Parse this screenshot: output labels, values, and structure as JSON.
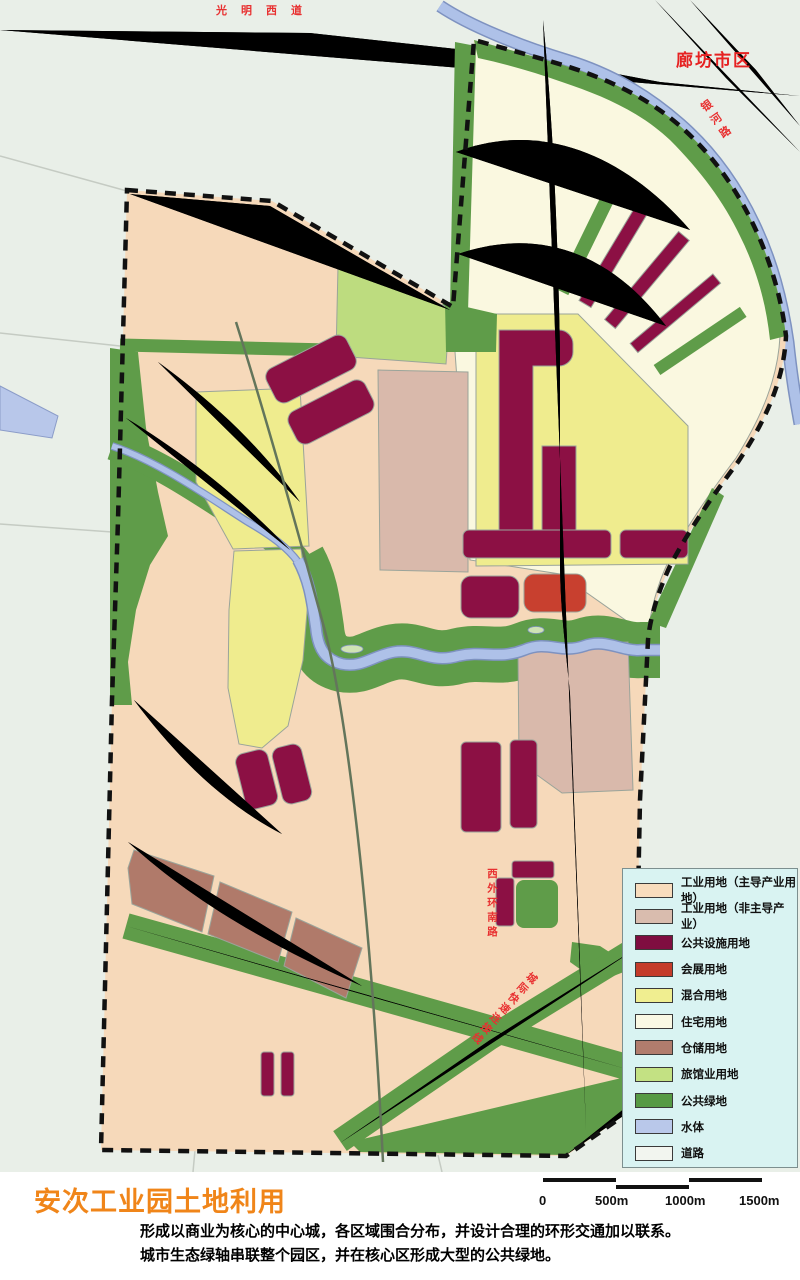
{
  "map": {
    "labels": {
      "road_top": "光明西道",
      "city": "廊坊市区",
      "road_ne": "银河路",
      "road_west_ring": "西外环南路",
      "road_intercity": "城际快速连接线"
    },
    "colors": {
      "background": "#e9efe8",
      "boundary": "#111111",
      "road_label_red": "#e83030",
      "city_label_red": "#e62222",
      "title_orange": "#f08519"
    }
  },
  "legend": {
    "items": [
      {
        "label": "工业用地（主导产业用地）",
        "color": "#f8dcbd"
      },
      {
        "label": "工业用地（非主导产业）",
        "color": "#d9bcae"
      },
      {
        "label": "公共设施用地",
        "color": "#7f0d40"
      },
      {
        "label": "会展用地",
        "color": "#c43b2a"
      },
      {
        "label": "混合用地",
        "color": "#f0ee90"
      },
      {
        "label": "住宅用地",
        "color": "#faf8e4"
      },
      {
        "label": "仓储用地",
        "color": "#b17c6d"
      },
      {
        "label": "旅馆业用地",
        "color": "#c3e183"
      },
      {
        "label": "公共绿地",
        "color": "#569a44"
      },
      {
        "label": "水体",
        "color": "#b9c8ea"
      },
      {
        "label": "道路",
        "color": "#f2f5ef"
      }
    ]
  },
  "footer": {
    "title": "安次工业园土地利用",
    "scale_labels": [
      "0",
      "500m",
      "1000m",
      "1500m"
    ],
    "description_lines": [
      "形成以商业为核心的中心城，各区域围合分布，并设计合理的环形交通加以联系。",
      "城市生态绿轴串联整个园区，并在核心区形成大型的公共绿地。"
    ]
  }
}
